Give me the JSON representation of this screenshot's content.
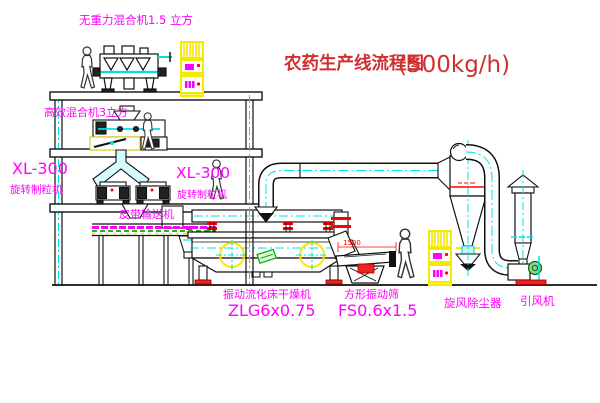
{
  "diagram": {
    "title": {
      "main": "农药生产线流程图",
      "capacity": "(500kg/h)"
    },
    "labels": {
      "top_mixer": "无重力混合机1.5 立方",
      "mixer2": "高效混合机3立方",
      "granulator_left_model": "XL-300",
      "granulator_left_name": "旋转制粒机",
      "granulator_mid_model": "XL-300",
      "granulator_mid_name": "旋转制粒机",
      "belt_conveyor": "皮带输送机",
      "dryer_name": "振动流化床干燥机",
      "dryer_model": "ZLG6x0.75",
      "sieve_name": "方形振动筛",
      "sieve_model": "FS0.6x1.5",
      "cyclone": "旋风除尘器",
      "fan": "引风机",
      "sieve_dim": "1500"
    },
    "colors": {
      "label_magenta": "#ff00ff",
      "title_red": "#cf3030",
      "pipe_cyan": "#00e0e0",
      "highlight_yellow": "#f5e900",
      "alert_red": "#ff0000",
      "line_black": "#1a1a1a",
      "green_accent": "#00aa00"
    }
  }
}
